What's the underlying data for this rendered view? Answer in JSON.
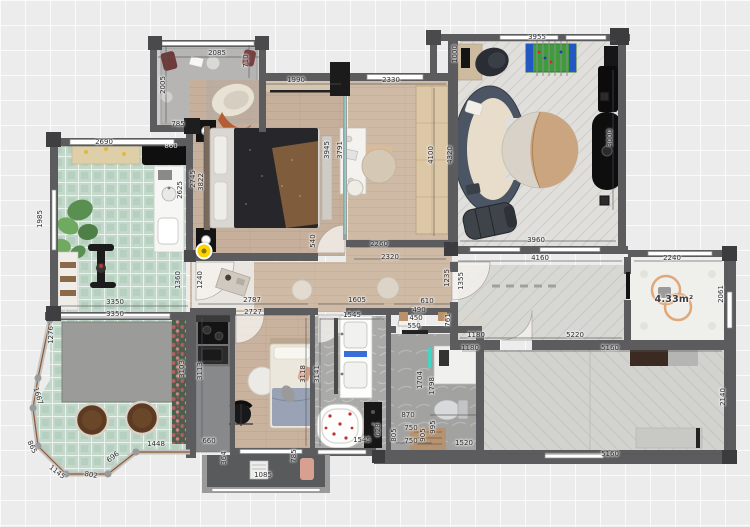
{
  "plan": {
    "type": "apartment-floor-plan",
    "grid_background": "#ebeceb",
    "wall_color": "#5c5c5e",
    "camera_marker_color": "#ffd400",
    "highlight_glass_color": "#44d6c4"
  },
  "dims": {
    "balcony_top_width": "2085",
    "balcony_left": "2005",
    "balcony_right": "710",
    "balcony_bottom": "785",
    "living_top_width": "1990",
    "study_top_width": "2330",
    "game_top_width": "3955",
    "game_left": "1000",
    "game_right": "3000",
    "game_inner": "4320",
    "study_right": "4100",
    "study_left_a": "3945",
    "study_left_b": "3791",
    "study_540": "540",
    "study_bottom_a": "2260",
    "study_bottom_b": "2320",
    "mbr_left": "3822",
    "gym_top_width": "2690",
    "gym_tv": "860",
    "gym_counter": "2625",
    "gym_right": "2745",
    "gym_left": "1985",
    "gym_bottom_width": "3350",
    "terrace_top_width": "3350",
    "terrace_left": "1276",
    "terrace_1667": "1667",
    "terrace_865": "865",
    "terrace_1145": "1145",
    "terrace_802": "802",
    "terrace_696": "696",
    "terrace_1448": "1448",
    "terrace_right": "3103",
    "entry_a": "1360",
    "entry_b": "1240",
    "kitchen_v": "3113",
    "kitchen_660": "660",
    "br2_top_a": "2787",
    "br2_top_b": "2727",
    "br2_right": "3118",
    "balcony2_left": "364",
    "balcony2_right": "785",
    "balcony2_bottom": "1085",
    "bath_top_a": "1605",
    "bath_top_b": "1545",
    "bath_left": "3141",
    "bath_bottom": "1545",
    "wc_top_a": "610",
    "wc_top_b": "490",
    "wc_top_c": "450",
    "wc_top_d": "550",
    "wc_va": "1704",
    "wc_vb": "1798",
    "wc_870": "870",
    "wc_750a": "750",
    "wc_750b": "750",
    "wc_628": "628",
    "wc_805": "805",
    "wc_905": "905",
    "wc_995": "995",
    "shower_bottom": "1520",
    "corridor_left_a": "1235",
    "corridor_left_b": "1355",
    "corridor_761": "761",
    "corridor_top_width": "4160",
    "corridor_bottom": "5220",
    "hall_bottom_a": "1180",
    "hall_bottom_b": "1180",
    "game_bottom_width": "3960",
    "rightroom_top_width": "2240",
    "rightroom_right": "2061",
    "area_rightroom": "4.33m²",
    "brr_top": "5160",
    "brr_bottom": "5160",
    "brr_right": "2140"
  }
}
